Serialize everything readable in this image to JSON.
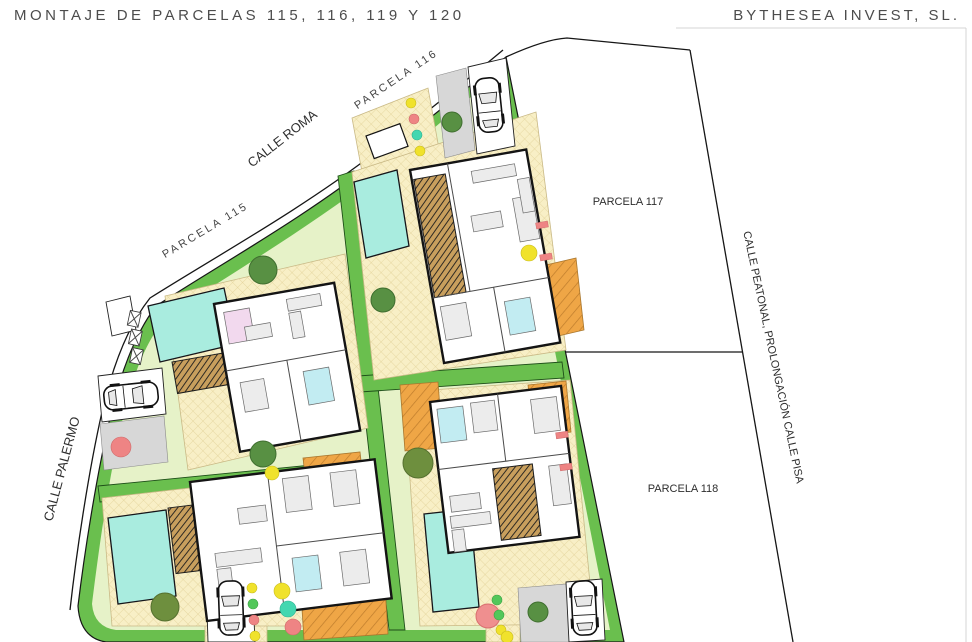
{
  "header": {
    "title": "MONTAJE DE PARCELAS 115, 116, 119 Y 120",
    "company": "BYTHESEA INVEST, SL."
  },
  "labels": {
    "calle_roma": "CALLE ROMA",
    "calle_palermo": "CALLE PALERMO",
    "calle_peatonal": "CALLE PEATONAL, PROLONGACIÓN CALLE PISA",
    "parcela_115": "PARCELA 115",
    "parcela_116": "PARCELA 116",
    "parcela_117": "PARCELA 117",
    "parcela_118": "PARCELA 118"
  },
  "colors": {
    "hedge": "#6abf4e",
    "lawn": "#e6f2c8",
    "terrace": "#f8efc6",
    "pool": "#a9ecdf",
    "deck": "#efa646",
    "pergola": "#c89f5d",
    "driveway": "#d7d7d7",
    "tree_dark": "#589043",
    "tree_olive": "#6e8f3e",
    "tree_pink": "#ef8f8f",
    "dot_yellow": "#f0e22c",
    "dot_red": "#ee8484",
    "dot_cyan": "#43d7b0",
    "dot_green": "#52c75a",
    "ink": "#1a1a1a"
  },
  "icons": {
    "car-icon": "top-view car outline",
    "tree-icon": "circular canopy",
    "shrub-dot-icon": "small colored circle",
    "meter-box-icon": "square utility box"
  }
}
